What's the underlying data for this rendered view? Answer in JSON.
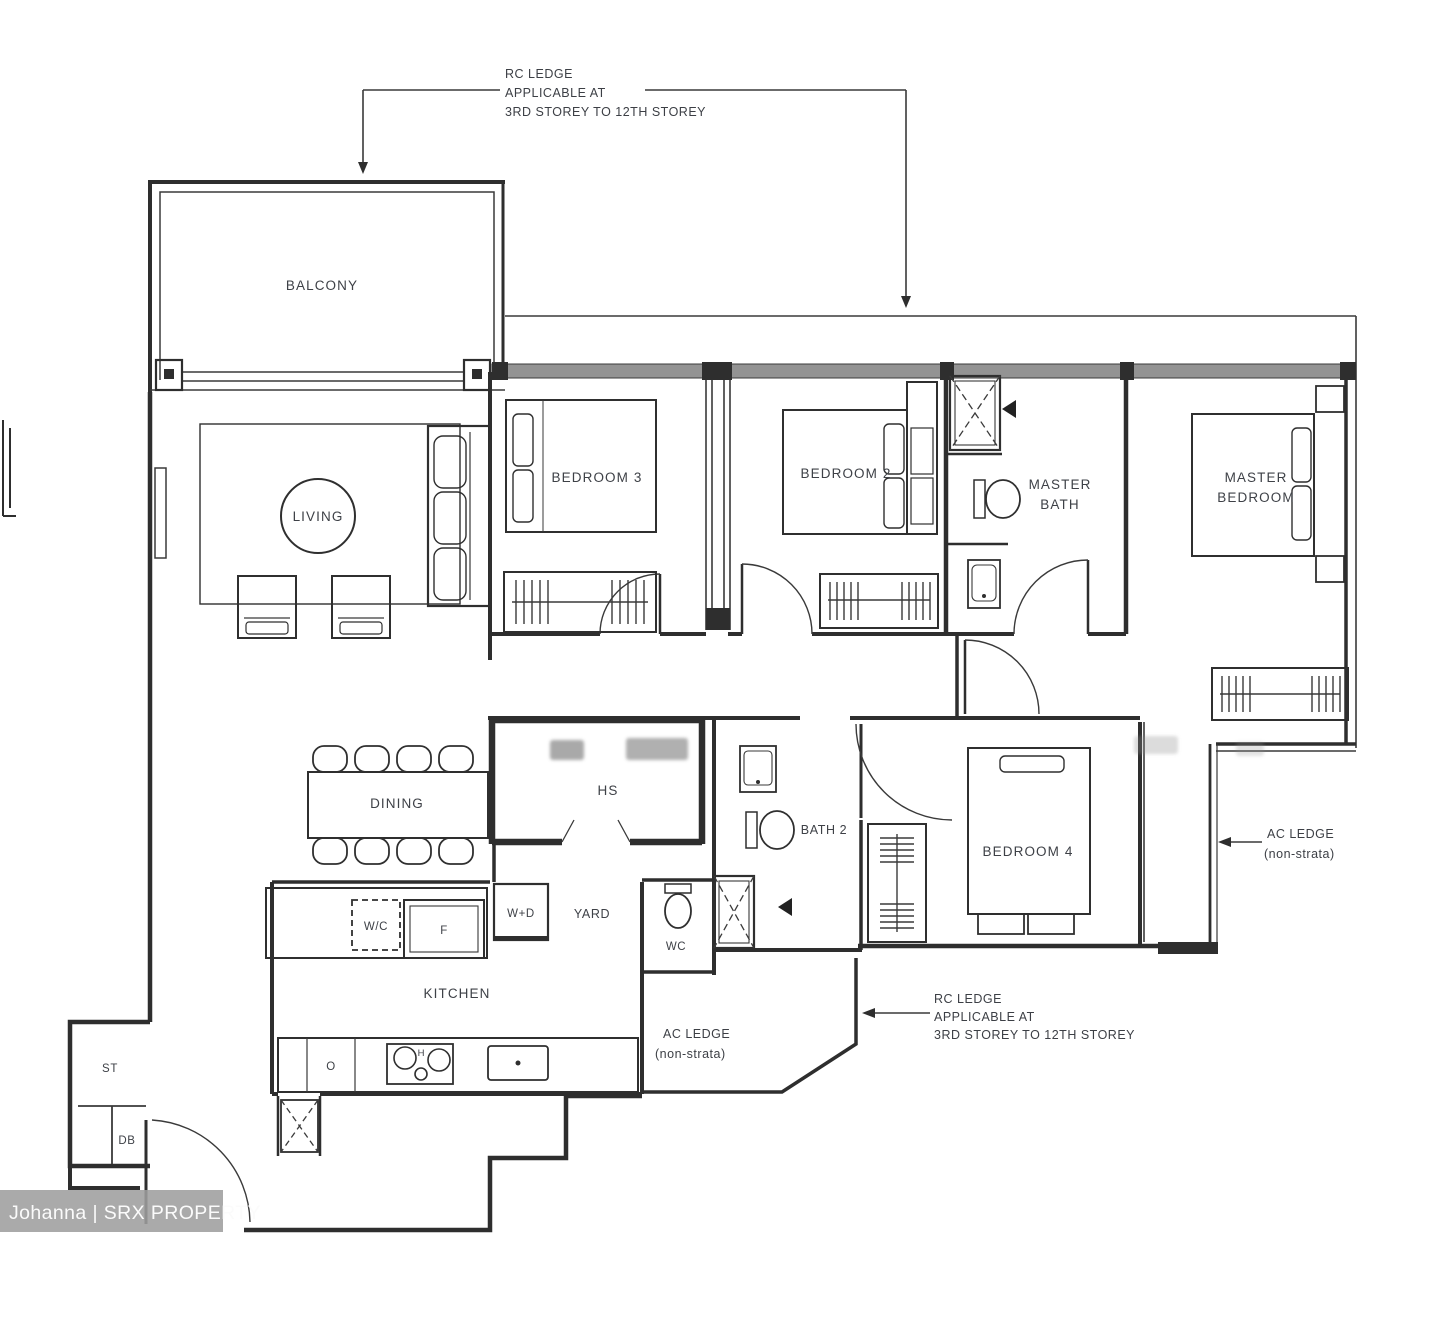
{
  "annotations": {
    "rc_ledge_top": {
      "line1": "RC LEDGE",
      "line2": "APPLICABLE AT",
      "line3": "3RD STOREY TO 12TH STOREY"
    },
    "rc_ledge_bottom": {
      "line1": "RC LEDGE",
      "line2": "APPLICABLE AT",
      "line3": "3RD STOREY TO 12TH STOREY"
    },
    "ac_ledge_right": {
      "line1": "AC LEDGE",
      "line2": "(non-strata)"
    },
    "ac_ledge_bottom": {
      "line1": "AC LEDGE",
      "line2": "(non-strata)"
    }
  },
  "rooms": {
    "balcony": "BALCONY",
    "living": "LIVING",
    "bedroom3": "BEDROOM 3",
    "bedroom2": "BEDROOM 2",
    "master_bath": {
      "line1": "MASTER",
      "line2": "BATH"
    },
    "master_bedroom": {
      "line1": "MASTER",
      "line2": "BEDROOM"
    },
    "dining": "DINING",
    "household_shelter": "HS",
    "bath2": "BATH 2",
    "bedroom4": "BEDROOM 4",
    "kitchen": "KITCHEN",
    "yard": "YARD",
    "wc": "WC",
    "store": "ST",
    "db": "DB"
  },
  "fixtures": {
    "water_closet_cabinet": "W/C",
    "fridge": "F",
    "washer_dryer": "W+D",
    "oven": "O",
    "hob": "H"
  },
  "watermark": {
    "text": "Johanna | SRX PROPERTY"
  },
  "colors": {
    "wall": "#2e2e2e",
    "label": "#3e4147",
    "window_band": "#939393",
    "watermark_band": "#9e9e9e",
    "watermark_text": "#fbfbfb"
  }
}
